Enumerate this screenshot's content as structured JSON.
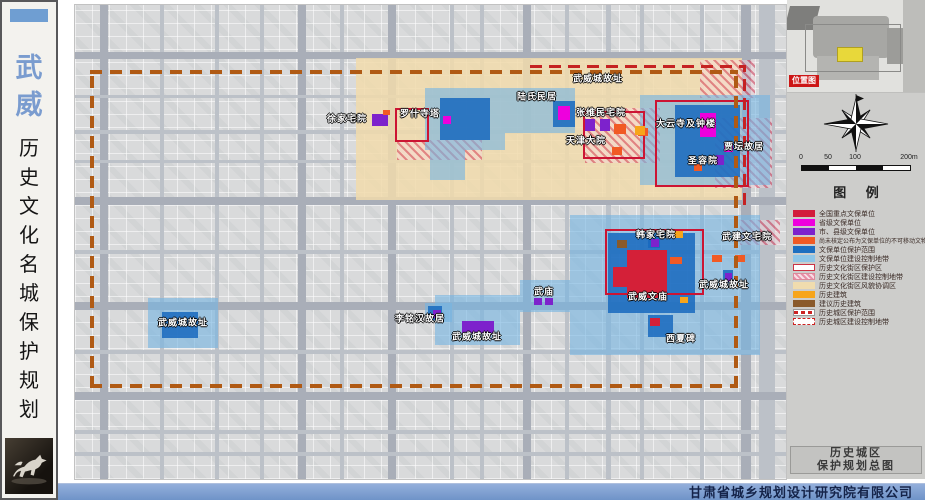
{
  "sidebar": {
    "city_chars": [
      "武",
      "威"
    ],
    "title_chars": [
      "历",
      "史",
      "文",
      "化",
      "名",
      "城",
      "保",
      "护",
      "规",
      "划"
    ]
  },
  "map": {
    "labels": [
      {
        "t": "武威城故址",
        "x": 523,
        "y": 73
      },
      {
        "t": "徐家宅院",
        "x": 272,
        "y": 113
      },
      {
        "t": "罗什寺塔",
        "x": 345,
        "y": 108
      },
      {
        "t": "陆氏民居",
        "x": 462,
        "y": 91
      },
      {
        "t": "张维民宅院",
        "x": 526,
        "y": 107
      },
      {
        "t": "天津大院",
        "x": 511,
        "y": 135
      },
      {
        "t": "大云寺及钟楼",
        "x": 611,
        "y": 118
      },
      {
        "t": "贾坛故居",
        "x": 669,
        "y": 141
      },
      {
        "t": "圣容院",
        "x": 628,
        "y": 155
      },
      {
        "t": "韩家宅院",
        "x": 581,
        "y": 229
      },
      {
        "t": "武建文宅院",
        "x": 672,
        "y": 231
      },
      {
        "t": "武威城故址",
        "x": 649,
        "y": 279
      },
      {
        "t": "武威文庙",
        "x": 573,
        "y": 291
      },
      {
        "t": "西夏碑",
        "x": 606,
        "y": 333
      },
      {
        "t": "武庙",
        "x": 469,
        "y": 286
      },
      {
        "t": "李铭汉故居",
        "x": 345,
        "y": 313
      },
      {
        "t": "武威城故址",
        "x": 402,
        "y": 331
      },
      {
        "t": "武威城故址",
        "x": 108,
        "y": 317
      }
    ],
    "zones": [
      {
        "c": "beige",
        "x": 281,
        "y": 53,
        "w": 386,
        "h": 142
      },
      {
        "c": "hatch",
        "x": 322,
        "y": 135,
        "w": 85,
        "h": 20
      },
      {
        "c": "hatch",
        "x": 510,
        "y": 103,
        "w": 75,
        "h": 55
      },
      {
        "c": "hatch",
        "x": 640,
        "y": 113,
        "w": 57,
        "h": 70
      },
      {
        "c": "hatch",
        "x": 665,
        "y": 215,
        "w": 40,
        "h": 25
      },
      {
        "c": "hatch",
        "x": 625,
        "y": 55,
        "w": 55,
        "h": 38
      },
      {
        "c": "lightblue",
        "x": 350,
        "y": 83,
        "w": 80,
        "h": 62
      },
      {
        "c": "lightblue",
        "x": 355,
        "y": 145,
        "w": 35,
        "h": 30
      },
      {
        "c": "lightblue",
        "x": 430,
        "y": 83,
        "w": 70,
        "h": 45
      },
      {
        "c": "lightblue",
        "x": 565,
        "y": 90,
        "w": 130,
        "h": 90
      },
      {
        "c": "lightblue",
        "x": 495,
        "y": 210,
        "w": 190,
        "h": 140
      },
      {
        "c": "lightblue",
        "x": 445,
        "y": 275,
        "w": 50,
        "h": 32
      },
      {
        "c": "lightblue",
        "x": 360,
        "y": 290,
        "w": 85,
        "h": 50
      },
      {
        "c": "lightblue",
        "x": 350,
        "y": 298,
        "w": 27,
        "h": 19
      },
      {
        "c": "lightblue",
        "x": 73,
        "y": 293,
        "w": 70,
        "h": 50
      },
      {
        "c": "darkblue",
        "x": 365,
        "y": 93,
        "w": 50,
        "h": 42
      },
      {
        "c": "darkblue",
        "x": 600,
        "y": 100,
        "w": 65,
        "h": 72
      },
      {
        "c": "darkblue",
        "x": 533,
        "y": 228,
        "w": 87,
        "h": 80
      },
      {
        "c": "darkblue",
        "x": 87,
        "y": 307,
        "w": 36,
        "h": 26
      },
      {
        "c": "darkblue",
        "x": 478,
        "y": 96,
        "w": 22,
        "h": 26
      },
      {
        "c": "darkblue",
        "x": 648,
        "y": 265,
        "w": 10,
        "h": 13
      },
      {
        "c": "darkblue",
        "x": 573,
        "y": 231,
        "w": 12,
        "h": 12
      },
      {
        "c": "darkblue",
        "x": 573,
        "y": 310,
        "w": 25,
        "h": 22
      },
      {
        "c": "darkblue",
        "x": 353,
        "y": 301,
        "w": 14,
        "h": 14
      },
      {
        "c": "redbox",
        "x": 320,
        "y": 103,
        "w": 30,
        "h": 30
      },
      {
        "c": "redbox",
        "x": 508,
        "y": 106,
        "w": 58,
        "h": 44
      },
      {
        "c": "redbox",
        "x": 580,
        "y": 95,
        "w": 90,
        "h": 83
      },
      {
        "c": "redbox",
        "x": 530,
        "y": 224,
        "w": 95,
        "h": 62
      }
    ],
    "sites": [
      {
        "c": "purple",
        "x": 297,
        "y": 109,
        "w": 16,
        "h": 12
      },
      {
        "c": "orange",
        "x": 308,
        "y": 105,
        "w": 7,
        "h": 5
      },
      {
        "c": "magenta",
        "x": 368,
        "y": 111,
        "w": 8,
        "h": 8
      },
      {
        "c": "magenta",
        "x": 483,
        "y": 101,
        "w": 12,
        "h": 14
      },
      {
        "c": "purple",
        "x": 510,
        "y": 114,
        "w": 10,
        "h": 12
      },
      {
        "c": "purple",
        "x": 525,
        "y": 114,
        "w": 10,
        "h": 12
      },
      {
        "c": "orange",
        "x": 539,
        "y": 119,
        "w": 12,
        "h": 10
      },
      {
        "c": "orange",
        "x": 563,
        "y": 123,
        "w": 10,
        "h": 8
      },
      {
        "c": "orange",
        "x": 537,
        "y": 142,
        "w": 10,
        "h": 8
      },
      {
        "c": "magenta",
        "x": 625,
        "y": 108,
        "w": 16,
        "h": 24
      },
      {
        "c": "amber",
        "x": 560,
        "y": 121,
        "w": 10,
        "h": 9
      },
      {
        "c": "orange",
        "x": 619,
        "y": 159,
        "w": 8,
        "h": 7
      },
      {
        "c": "purple",
        "x": 641,
        "y": 150,
        "w": 8,
        "h": 10
      },
      {
        "c": "magenta",
        "x": 649,
        "y": 138,
        "w": 9,
        "h": 9
      },
      {
        "c": "purple",
        "x": 576,
        "y": 234,
        "w": 8,
        "h": 8
      },
      {
        "c": "amber",
        "x": 599,
        "y": 226,
        "w": 9,
        "h": 7
      },
      {
        "c": "brown",
        "x": 542,
        "y": 235,
        "w": 10,
        "h": 8
      },
      {
        "c": "orange",
        "x": 571,
        "y": 247,
        "w": 10,
        "h": 7
      },
      {
        "c": "orange",
        "x": 595,
        "y": 252,
        "w": 12,
        "h": 7
      },
      {
        "c": "crimson",
        "x": 552,
        "y": 245,
        "w": 40,
        "h": 48
      },
      {
        "c": "crimson",
        "x": 538,
        "y": 262,
        "w": 16,
        "h": 20
      },
      {
        "c": "amber",
        "x": 605,
        "y": 292,
        "w": 8,
        "h": 6
      },
      {
        "c": "orange",
        "x": 637,
        "y": 250,
        "w": 10,
        "h": 7
      },
      {
        "c": "orange",
        "x": 660,
        "y": 250,
        "w": 10,
        "h": 7
      },
      {
        "c": "purple",
        "x": 650,
        "y": 268,
        "w": 7,
        "h": 9
      },
      {
        "c": "purple",
        "x": 459,
        "y": 293,
        "w": 8,
        "h": 7
      },
      {
        "c": "purple",
        "x": 470,
        "y": 293,
        "w": 8,
        "h": 7
      },
      {
        "c": "purple",
        "x": 358,
        "y": 305,
        "w": 8,
        "h": 8
      },
      {
        "c": "purple",
        "x": 387,
        "y": 316,
        "w": 32,
        "h": 12
      },
      {
        "c": "crimson",
        "x": 575,
        "y": 313,
        "w": 10,
        "h": 8
      }
    ],
    "roads": {
      "v": [
        {
          "x": 25,
          "w": 8,
          "m": 0
        },
        {
          "x": 223,
          "w": 8,
          "m": 0
        },
        {
          "x": 313,
          "w": 8,
          "m": 0
        },
        {
          "x": 448,
          "w": 8,
          "m": 0
        },
        {
          "x": 666,
          "w": 10,
          "m": 0
        },
        {
          "x": 684,
          "w": 16,
          "m": 1
        },
        {
          "x": 85,
          "w": 4,
          "m": 1
        },
        {
          "x": 140,
          "w": 4,
          "m": 1
        },
        {
          "x": 185,
          "w": 4,
          "m": 1
        },
        {
          "x": 265,
          "w": 4,
          "m": 1
        },
        {
          "x": 375,
          "w": 4,
          "m": 1
        },
        {
          "x": 405,
          "w": 4,
          "m": 1
        },
        {
          "x": 490,
          "w": 4,
          "m": 1
        },
        {
          "x": 531,
          "w": 5,
          "m": 1
        },
        {
          "x": 565,
          "w": 4,
          "m": 1
        },
        {
          "x": 625,
          "w": 4,
          "m": 1
        }
      ],
      "h": [
        {
          "y": 47,
          "h": 7,
          "m": 0
        },
        {
          "y": 192,
          "h": 8,
          "m": 0
        },
        {
          "y": 297,
          "h": 8,
          "m": 0
        },
        {
          "y": 387,
          "h": 8,
          "m": 0
        },
        {
          "y": 90,
          "h": 3,
          "m": 1
        },
        {
          "y": 125,
          "h": 4,
          "m": 1
        },
        {
          "y": 155,
          "h": 3,
          "m": 1
        },
        {
          "y": 245,
          "h": 4,
          "m": 1
        },
        {
          "y": 345,
          "h": 4,
          "m": 1
        },
        {
          "y": 425,
          "h": 4,
          "m": 1
        },
        {
          "y": 447,
          "h": 4,
          "m": 1
        }
      ]
    },
    "boundaries": {
      "orange_rect": {
        "x": 15,
        "y": 65,
        "w": 648,
        "h": 318
      },
      "red_h": {
        "x": 455,
        "y": 60,
        "w": 215
      },
      "red_v": {
        "x": 668,
        "y": 60,
        "h": 140
      }
    }
  },
  "panel": {
    "location_label": "位置图",
    "legend_title": "图 例",
    "legend_items": [
      {
        "s": "crimson",
        "label": "全国重点文保单位"
      },
      {
        "s": "magenta",
        "label": "省级文保单位"
      },
      {
        "s": "purple",
        "label": "市、县级文保单位"
      },
      {
        "s": "orange",
        "label": "尚未核定公布为文保单位的不可移动文物"
      },
      {
        "s": "blue",
        "label": "文保单位保护范围"
      },
      {
        "s": "lightblue",
        "label": "文保单位建设控制地带"
      },
      {
        "s": "outline-red",
        "label": "历史文化街区保护区"
      },
      {
        "s": "hatch-pink",
        "label": "历史文化街区建设控制地带"
      },
      {
        "s": "beige",
        "label": "历史文化街区风貌协调区"
      },
      {
        "s": "amber",
        "label": "历史建筑"
      },
      {
        "s": "brown",
        "label": "建议历史建筑"
      },
      {
        "s": "dashfill-red",
        "label": "历史城区保护范围"
      },
      {
        "s": "dash-red",
        "label": "历史城区建设控制地带"
      }
    ],
    "scale_labels": [
      {
        "t": "0",
        "x": 0
      },
      {
        "t": "50",
        "x": 27
      },
      {
        "t": "100",
        "x": 54
      },
      {
        "t": "200m",
        "x": 108
      }
    ],
    "sheet_title_line1": "历史城区",
    "sheet_title_line2": "保护规划总图"
  },
  "footer": {
    "company": "甘肃省城乡规划设计研究院有限公司"
  },
  "colors": {
    "national": "#d21c3c",
    "provincial": "#ee00dd",
    "county": "#7d22cc",
    "unregistered": "#f15a24",
    "protection_scope": "#1d6fc0",
    "control_zone": "#8ec6e8",
    "coordination": "#f0dcae",
    "historic_building": "#f7a51b",
    "suggested_building": "#8a5a2b",
    "city_boundary_orange": "#b05a14",
    "city_boundary_red": "#c52222",
    "footer_bar": "#7b9bd0"
  }
}
